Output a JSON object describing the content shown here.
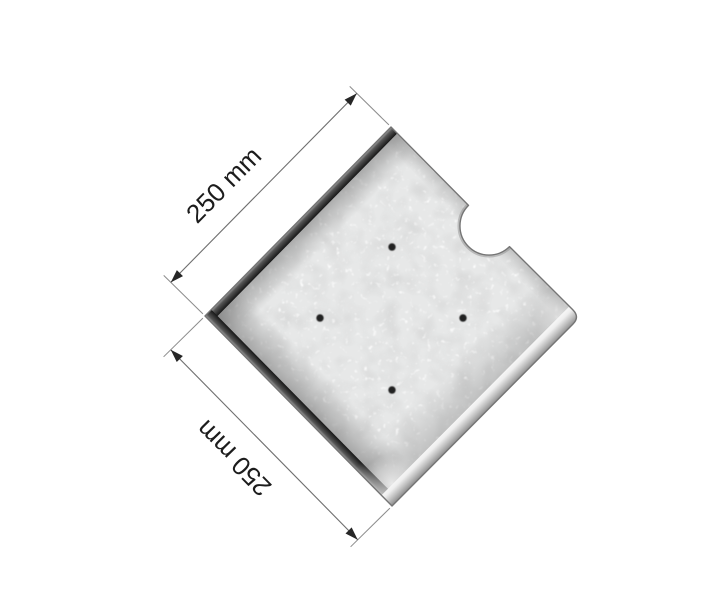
{
  "diagram": {
    "background_color": "#ffffff",
    "dimensions": {
      "top": {
        "label": "250 mm"
      },
      "left": {
        "label": "250 mm"
      }
    },
    "plate": {
      "shape": "square-slab-with-notch",
      "notch_count": 1,
      "hole_count": 4,
      "holes": [
        {
          "x": 392,
          "y": 247
        },
        {
          "x": 320,
          "y": 318
        },
        {
          "x": 463,
          "y": 318
        },
        {
          "x": 392,
          "y": 390
        }
      ],
      "hole_radius": 3.7,
      "surface_color": "#e7e8e8",
      "speckle_color": "#ffffff",
      "edge_dark_color": "#161616",
      "bevel_light_color": "#f6f6f6",
      "outline_color": "#757575",
      "hole_color": "#222222"
    },
    "annotation": {
      "line_color": "#6e6e6e",
      "extension_line_color": "#8c8c8c",
      "arrow_color": "#262626",
      "text_color": "#1c1c1c"
    }
  }
}
